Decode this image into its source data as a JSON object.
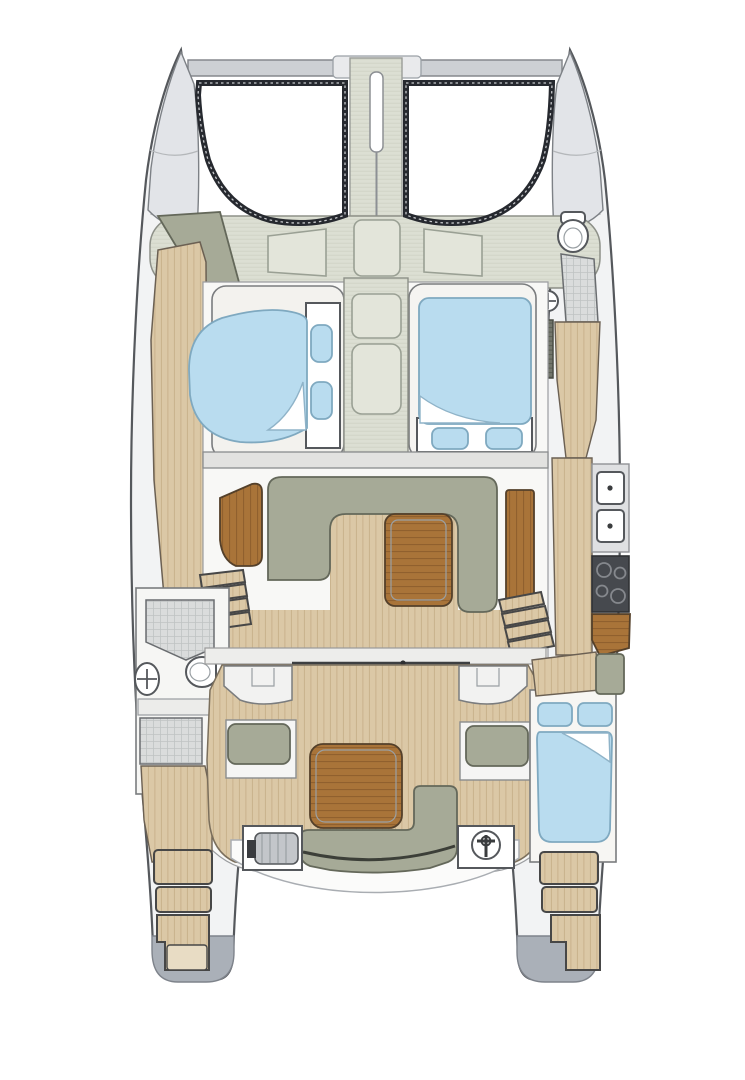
{
  "document": {
    "type": "catamaran-deck-plan",
    "view": "top-down floor plan, no text labels"
  },
  "colors": {
    "background": "#ffffff",
    "outline": "#55585c",
    "hull_fill": "#f2f3f4",
    "bow_cone": "#e2e4e8",
    "beam": "#cdd0d4",
    "fitting_plate": "#e9eaec",
    "fitting_pill": "#c7cacf",
    "trampoline_base": "#4e525b",
    "trampoline_grid": "#5f636d",
    "deck_canvas": "#dcdfd3",
    "deck_canvas_line": "#cfd2c5",
    "hatch_fill": "#e3e5da",
    "wood_base": "#dbc8a6",
    "wood_stripe": "#c8b28c",
    "teak_base": "#a97439",
    "teak_grain": "#8e5e2c",
    "cushion": "#a6aa97",
    "bed_blue": "#b9dcef",
    "room_white": "#f8f8f6",
    "bulkhead": "#e2e2e0",
    "tile_base": "#dadcdc",
    "tile_line": "#bfc3c3",
    "louver": "#73766c",
    "stove": "#46494e",
    "metal": "#c3c6ca",
    "stern_cap": "#aab0b8",
    "white": "#ffffff"
  },
  "areas": [
    {
      "name": "bow-crossbeam"
    },
    {
      "name": "bowsprit-walkway"
    },
    {
      "name": "port-trampoline"
    },
    {
      "name": "starboard-trampoline"
    },
    {
      "name": "foredeck-with-hatches"
    },
    {
      "name": "port-bow-sun-pad"
    },
    {
      "name": "starboard-forward-head"
    },
    {
      "name": "port-forward-cabin-berth"
    },
    {
      "name": "starboard-forward-cabin-berth"
    },
    {
      "name": "companionway-walkway-hatches"
    },
    {
      "name": "salon-u-settee"
    },
    {
      "name": "salon-table"
    },
    {
      "name": "chart-seat"
    },
    {
      "name": "galley-twin-sinks"
    },
    {
      "name": "galley-stove"
    },
    {
      "name": "galley-worktop"
    },
    {
      "name": "port-mid-head-shower"
    },
    {
      "name": "cockpit-floor"
    },
    {
      "name": "cockpit-table"
    },
    {
      "name": "cockpit-side-benches"
    },
    {
      "name": "cockpit-aft-bench"
    },
    {
      "name": "winch"
    },
    {
      "name": "transom-locker"
    },
    {
      "name": "starboard-aft-cabin-berth"
    },
    {
      "name": "port-swim-platform-steps"
    },
    {
      "name": "starboard-swim-platform-steps"
    }
  ]
}
